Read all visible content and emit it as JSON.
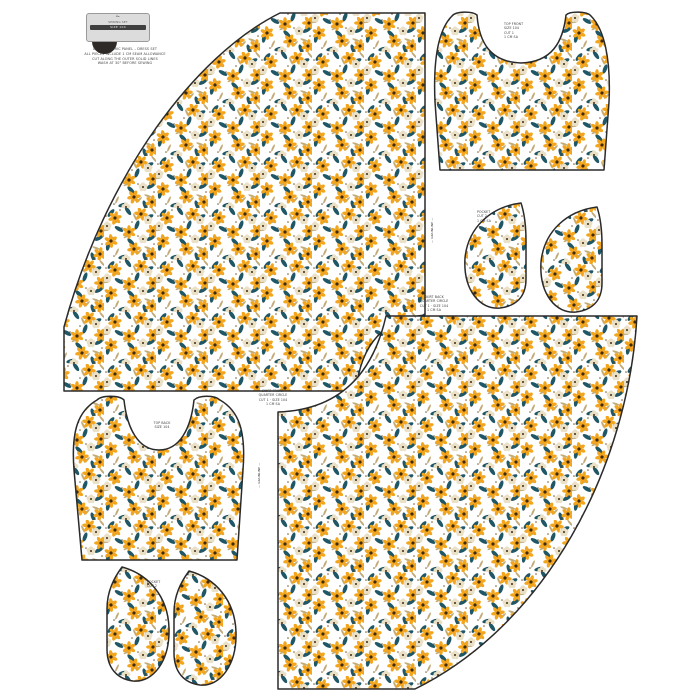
{
  "colors": {
    "fabric_bg": "#FFFFFF",
    "flower_yellow": "#F2A51D",
    "flower_center": "#3F2A12",
    "flower_cream": "#EAE0C6",
    "leaf_teal": "#1F5766",
    "sprig_tan": "#C2AB76",
    "dot_brown": "#7A5A2E",
    "outline": "#2A2A2A",
    "tag_bg": "#DCDCDC",
    "tag_band": "#3F3F3F",
    "circle_dark": "#2E2A27"
  },
  "brand_tag": {
    "glyph": "✁",
    "line1": "SEWING SET",
    "band": "SIZE 104",
    "fine_print": "DIGITAL FABRIC PANEL – DRESS SET\nALL PIECES INCLUDE 1 CM SEAM ALLOWANCE\nCUT ALONG THE OUTER SOLID LINES\nWASH AT 30° BEFORE SEWING"
  },
  "labels": {
    "top_bodice": "TOP FRONT\nSIZE 104\nCUT 1\n1 CM SA",
    "right_pockets": "POCKET\nCUT 2\n1 CM SA",
    "top_skirt": "SKIRT FRONT\nQUARTER CIRCLE\nCUT 1 · SIZE 104\n1 CM SA",
    "bottom_skirt": "SKIRT BACK\nQUARTER CIRCLE\nCUT 1 · SIZE 104\n1 CM SA",
    "bottom_bodice": "TOP BACK\nSIZE 104",
    "bottom_pockets": "POCKET\nCUT 2",
    "grain_right": "— GRAINLINE —",
    "grain_left": "— GRAINLINE —"
  }
}
